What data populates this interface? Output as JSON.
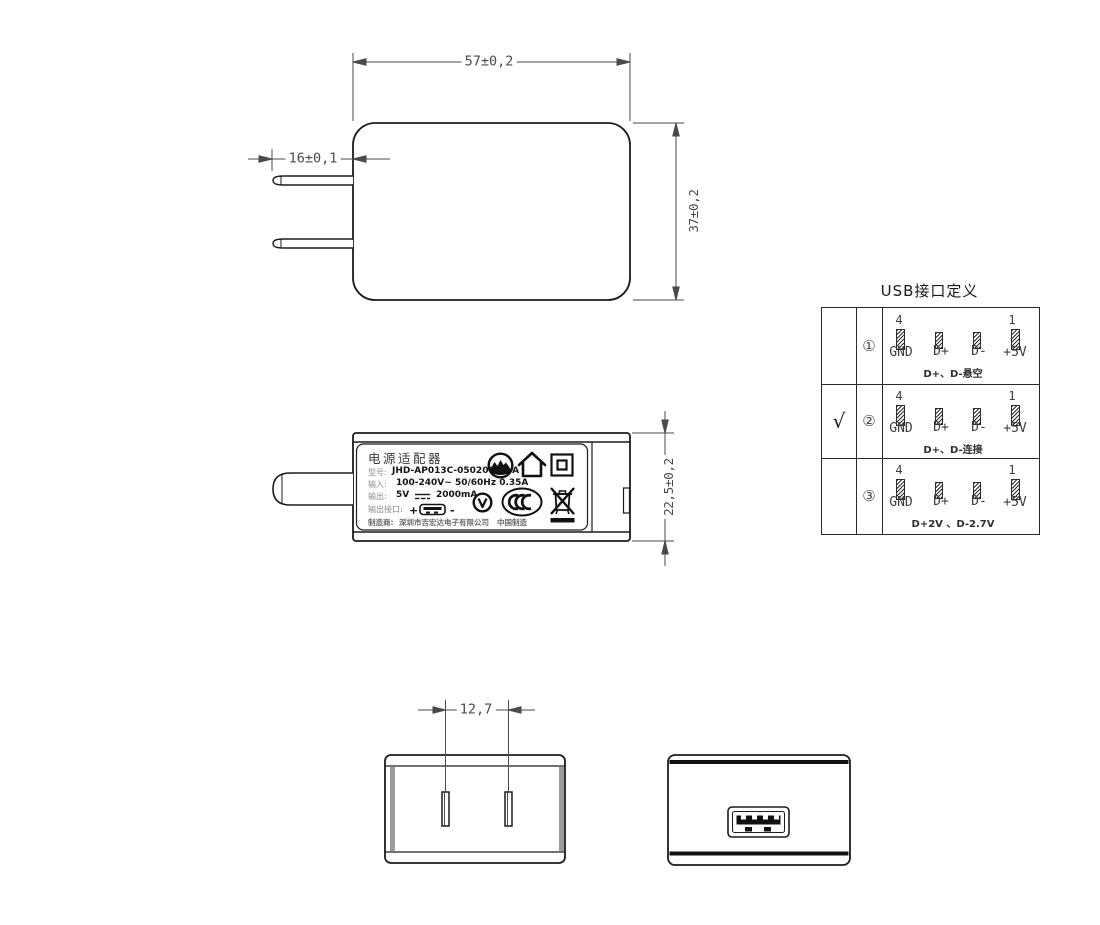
{
  "front_view": {
    "width_dim": "57±0,2",
    "height_dim": "37±0,2",
    "prong_dim": "16±0,1"
  },
  "side_view": {
    "thickness_dim": "22,5±0,2",
    "label": {
      "title": "电源适配器",
      "model_label": "型号:",
      "model_value": "JHD-AP013C-050200BB-A",
      "input_label": "输入:",
      "input_value": "100-240V~  50/60Hz  0.35A",
      "output_label": "输出:",
      "output_voltage": "5V",
      "output_current": "2000mA",
      "port_label": "输出接口:",
      "port_plus": "+",
      "port_minus": "-",
      "maker_label": "制造商:",
      "maker_value": "深圳市吉宏达电子有限公司",
      "made_in": "中国制造",
      "icons": [
        "altitude-limit-icon",
        "indoor-use-icon",
        "class-ii-icon",
        "v-check-icon",
        "ccc-mark-icon",
        "weee-bin-icon",
        "dc-symbol-icon",
        "usb-port-icon"
      ]
    }
  },
  "usb_table": {
    "title": "USB接口定义",
    "rows": [
      {
        "check": "",
        "num": "①",
        "pin_first": "4",
        "pin_last": "1",
        "pins": [
          "GND",
          "D+",
          "D-",
          "+5V"
        ],
        "note": "D+、D-悬空"
      },
      {
        "check": "√",
        "num": "②",
        "pin_first": "4",
        "pin_last": "1",
        "pins": [
          "GND",
          "D+",
          "D-",
          "+5V"
        ],
        "note": "D+、D-连接"
      },
      {
        "check": "",
        "num": "③",
        "pin_first": "4",
        "pin_last": "1",
        "pins": [
          "GND",
          "D+",
          "D-",
          "+5V"
        ],
        "note": "D+2V 、D-2.7V"
      }
    ]
  },
  "bottom_view": {
    "pitch_dim": "12,7"
  },
  "colors": {
    "object_line": "#1c1c1c",
    "dim_line": "#4a4a4a",
    "hatch": "#2b2b2b"
  }
}
